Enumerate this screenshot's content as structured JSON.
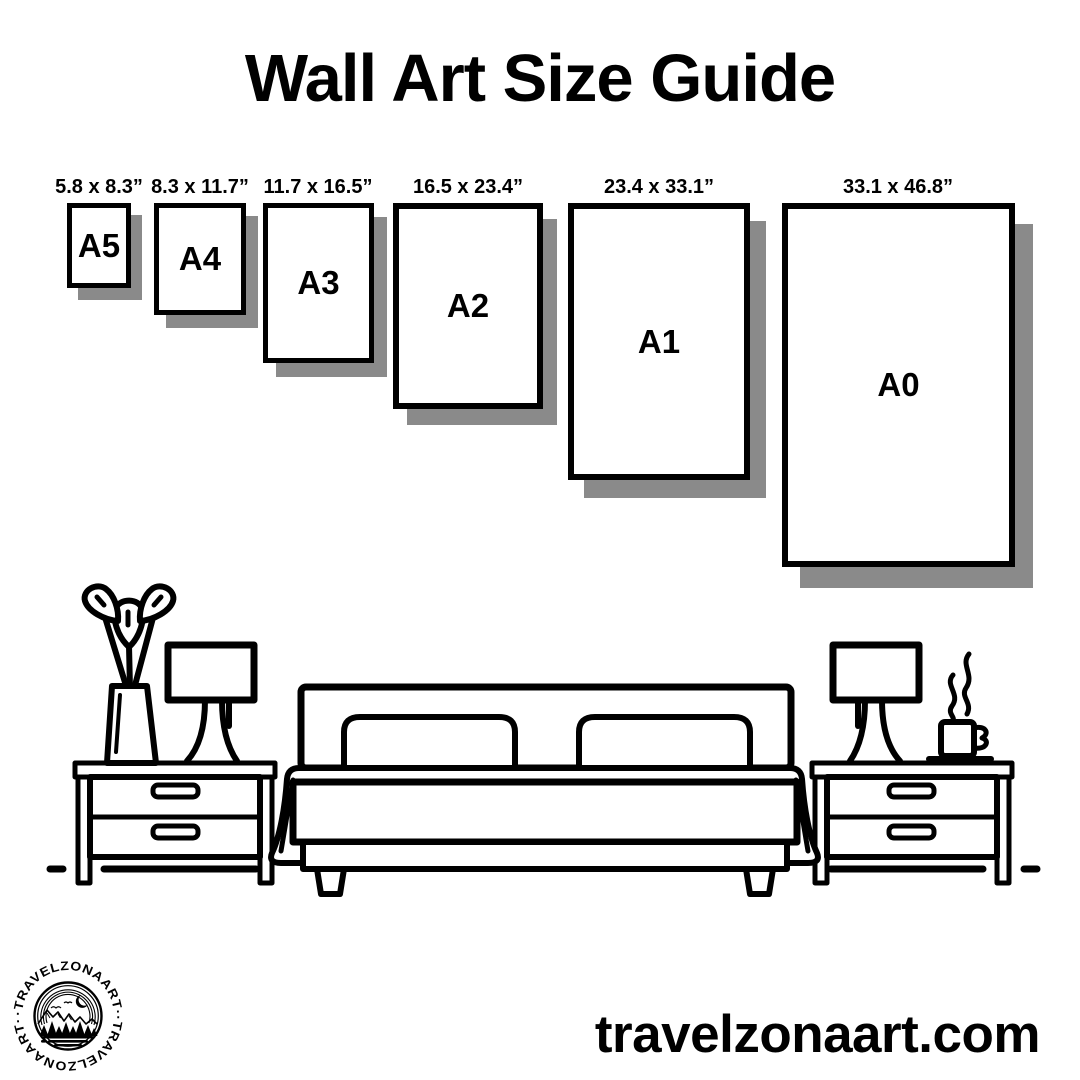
{
  "title": "Wall Art Size Guide",
  "website": "travelzonaart.com",
  "brand": "TRAVELZONAART",
  "logo": {
    "ring_text": "·TRAVELZONAART··TRAVELZONAART·"
  },
  "colors": {
    "ink": "#000000",
    "paper": "#ffffff",
    "shadow": "#8a8a8a"
  },
  "sizes": [
    {
      "code": "A5",
      "label": "5.8 x 8.3”"
    },
    {
      "code": "A4",
      "label": "8.3 x 11.7”"
    },
    {
      "code": "A3",
      "label": "11.7 x 16.5”"
    },
    {
      "code": "A2",
      "label": "16.5 x 23.4”"
    },
    {
      "code": "A1",
      "label": "23.4 x 33.1”"
    },
    {
      "code": "A0",
      "label": "33.1 x 46.8”"
    }
  ],
  "illustration": {
    "icons": [
      "double-bed-icon",
      "pillow-icon",
      "nightstand-icon",
      "table-lamp-icon",
      "plant-vase-icon",
      "coffee-cup-icon",
      "steam-icon",
      "floor-line"
    ]
  }
}
